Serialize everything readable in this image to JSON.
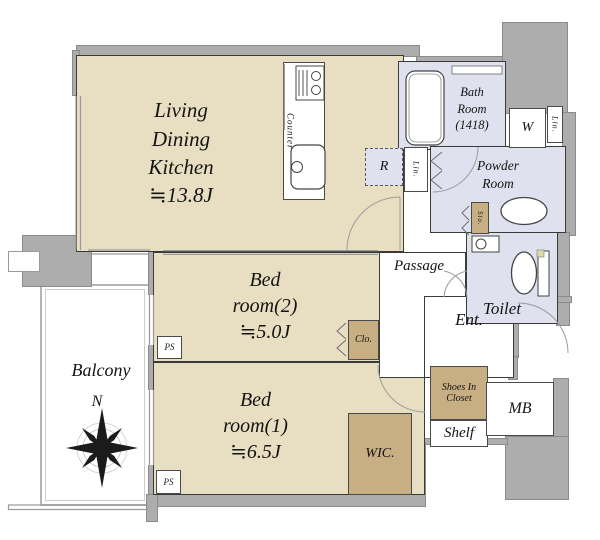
{
  "colors": {
    "floor_beige": "#e8dfc2",
    "storage_brown": "#c7ae83",
    "wet_area_blue": "#dfe2ee",
    "wall_gray": "#adadad"
  },
  "rooms": {
    "ldk": {
      "lines": [
        "Living",
        "Dining",
        "Kitchen"
      ],
      "area": "≒13.8J"
    },
    "bedroom2": {
      "lines": [
        "Bed",
        "room(2)"
      ],
      "area": "≒5.0J"
    },
    "bedroom1": {
      "lines": [
        "Bed",
        "room(1)"
      ],
      "area": "≒6.5J"
    },
    "balcony": {
      "name": "Balcony"
    },
    "bath": {
      "lines": [
        "Bath",
        "Room",
        "(1418)"
      ]
    },
    "powder": {
      "lines": [
        "Powder",
        "Room"
      ]
    },
    "toilet": {
      "name": "Toilet"
    },
    "passage": {
      "name": "Passage"
    },
    "entrance": {
      "name": "Ent."
    }
  },
  "storage": {
    "wic": "WIC.",
    "closet": "Clo.",
    "shoes": [
      "Shoes In",
      "Closet"
    ],
    "shelf": "Shelf",
    "linen": "Lin.",
    "small_storage": "Sto."
  },
  "labels": {
    "washer": "W",
    "refrigerator": "R",
    "counter": "Counter",
    "meter_box": "MB",
    "pipe_space": "PS",
    "north": "N"
  }
}
